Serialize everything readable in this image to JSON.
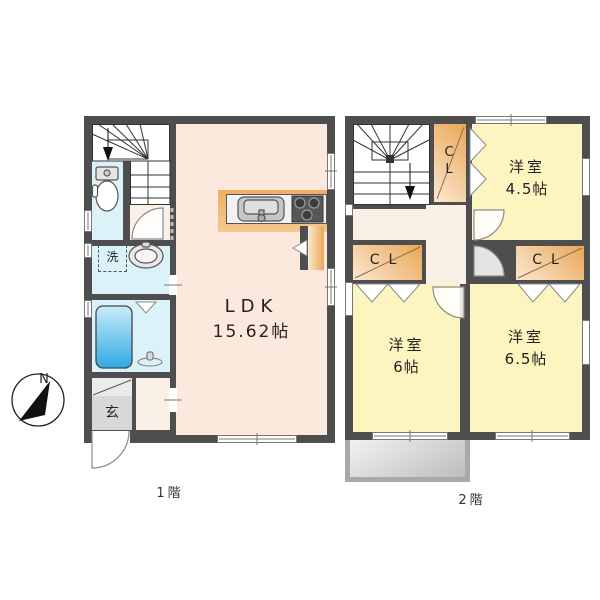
{
  "title": "2-story house floor plan",
  "compass": {
    "north": "N"
  },
  "floor1": {
    "caption": "1階",
    "ldk_name": "LDK",
    "ldk_size": "15.62帖",
    "laundry": "洗",
    "entrance": "玄"
  },
  "floor2": {
    "caption": "2階",
    "room_small": {
      "name": "洋室",
      "size": "4.5帖"
    },
    "room_left": {
      "name": "洋室",
      "size": "6帖"
    },
    "room_right": {
      "name": "洋室",
      "size": "6.5帖"
    },
    "closet_stairs": "CL",
    "closet_left": "CL",
    "closet_right": "CL"
  },
  "colors": {
    "wall": "#4e4e4e",
    "ldk": "#fce8dc",
    "hall": "#fbf0e5",
    "tatami": "#fcf5c0",
    "wet": "#dbf3f8",
    "closet_dark": "#eaa758",
    "closet_light": "#fbe8d0",
    "entrance": "#d8d8d8",
    "shoe": "#ebebeb",
    "balcony_light": "#f2f2f2",
    "balcony_dark": "#bdbdbd",
    "balcony_frame": "#a9a9a9",
    "tub_dark": "#2fa9e2",
    "tub_light": "#c9ecfa"
  }
}
